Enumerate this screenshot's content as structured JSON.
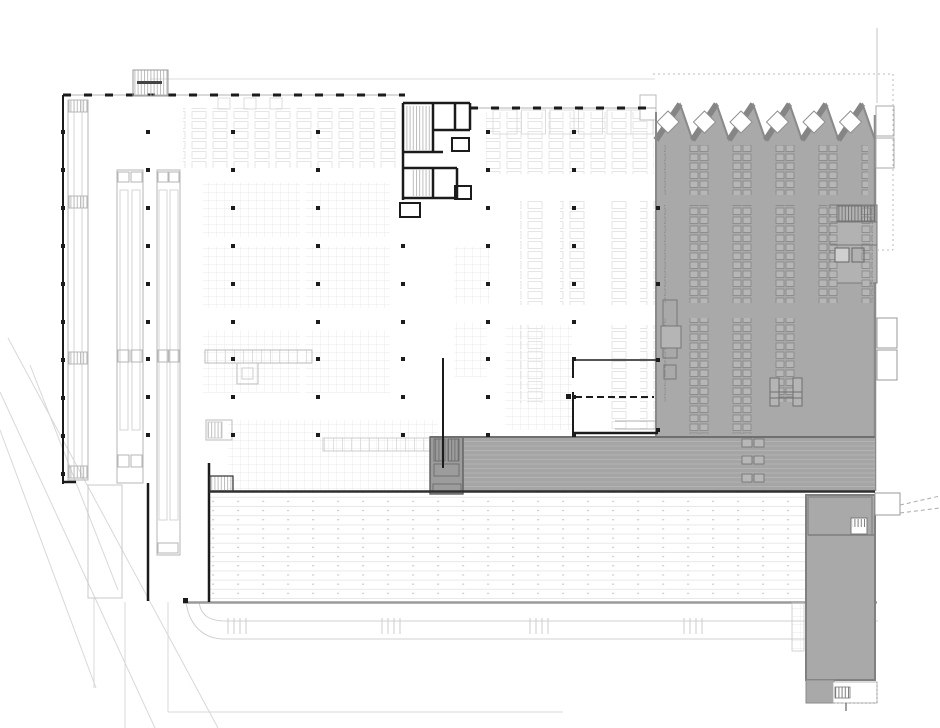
{
  "document": {
    "type": "architectural-floor-plan",
    "description": "ground floor plan of a large industrial production and logistics hall with shaded sawtooth-roof production zone",
    "aria_label": "Architectural floor plan drawing"
  },
  "palette": {
    "background": "#ffffff",
    "wall": "#1b1b1b",
    "shaded_zone": "#a9a9a9",
    "shaded_zone_light": "#b2b2b2",
    "zone_outline": "#8a8a8a",
    "band_fill": "#a5a5a5",
    "stair_block": "#9c9c9c",
    "faint_line": "#e2e2e2",
    "medium_line": "#b6b6b6",
    "site_line": "#d8d8d8",
    "column": "#1c1c1c"
  },
  "plan": {
    "column_grid": {
      "xs": [
        148,
        233,
        318,
        403,
        488,
        574
      ],
      "ys": [
        132,
        170,
        208,
        246,
        284,
        322,
        359,
        397,
        435
      ],
      "skip": [
        [
          403,
          132
        ],
        [
          403,
          170
        ],
        [
          403,
          208
        ]
      ],
      "wall_x": 63,
      "wall_ys": [
        132,
        170,
        208,
        246,
        284,
        322,
        360,
        398,
        436,
        474
      ],
      "edge_x": 658,
      "edge_ys": [
        208,
        284,
        360,
        430
      ],
      "size": 4
    },
    "sawtooth": {
      "x0": 656,
      "valley_y": 140,
      "peak_y": 104,
      "run": 24,
      "drop": 12.5,
      "count": 6,
      "bottom_y": 437,
      "skylight_half": 11
    },
    "rack_zones": [
      [
        183,
        108,
        214,
        60,
        "pat-ladder"
      ],
      [
        486,
        112,
        74,
        62,
        "pat-ladder"
      ],
      [
        560,
        112,
        94,
        62,
        "pat-ladder"
      ],
      [
        203,
        182,
        97,
        55,
        "pat-grid"
      ],
      [
        305,
        182,
        85,
        55,
        "pat-grid"
      ],
      [
        203,
        246,
        97,
        62,
        "pat-grid"
      ],
      [
        305,
        246,
        85,
        62,
        "pat-grid"
      ],
      [
        455,
        247,
        35,
        57,
        "pat-grid"
      ],
      [
        520,
        200,
        26,
        105,
        "pat-ladder"
      ],
      [
        560,
        200,
        26,
        105,
        "pat-ladder"
      ],
      [
        606,
        200,
        26,
        105,
        "pat-ladder"
      ],
      [
        640,
        200,
        16,
        105,
        "pat-ladder"
      ],
      [
        203,
        330,
        97,
        63,
        "pat-grid"
      ],
      [
        305,
        330,
        85,
        63,
        "pat-grid"
      ],
      [
        455,
        322,
        32,
        55,
        "pat-grid"
      ],
      [
        505,
        325,
        67,
        105,
        "pat-grid"
      ],
      [
        520,
        325,
        26,
        78,
        "pat-ladder"
      ],
      [
        606,
        325,
        24,
        105,
        "pat-ladder"
      ],
      [
        640,
        325,
        16,
        105,
        "pat-ladder"
      ],
      [
        228,
        420,
        210,
        70,
        "pat-grid"
      ],
      [
        445,
        438,
        162,
        52,
        "pat-grid"
      ],
      [
        553,
        345,
        19,
        50,
        "pat-grid"
      ],
      [
        553,
        400,
        19,
        30,
        "pat-grid"
      ]
    ],
    "machine_zones": [
      [
        664,
        145,
        204,
        50
      ],
      [
        664,
        205,
        209,
        98
      ],
      [
        664,
        318,
        150,
        84
      ],
      [
        686,
        364,
        74,
        70
      ]
    ],
    "band_items": {
      "x": 742,
      "ys": [
        439,
        456,
        474
      ],
      "w": 10,
      "h": 8,
      "gap": 12
    },
    "dock_ticks": {
      "xs": [
        228,
        382,
        530,
        684
      ],
      "y": 618,
      "len": 16,
      "spacing": 6,
      "count": 4
    }
  }
}
